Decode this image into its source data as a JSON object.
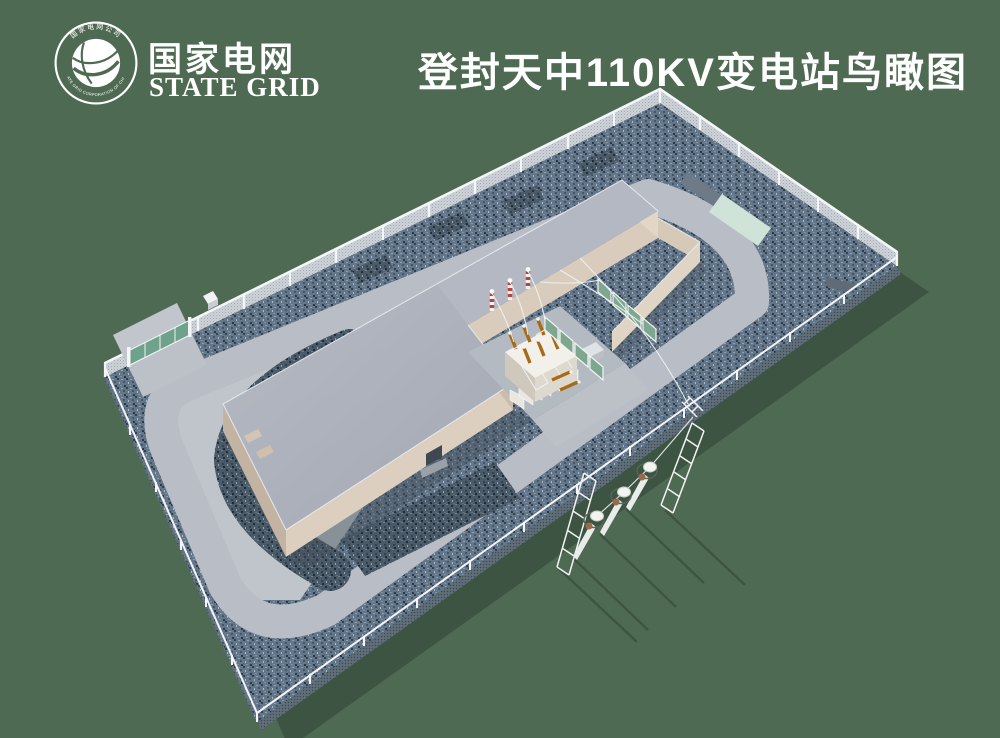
{
  "header": {
    "title": "登封天中110KV变电站鸟瞰图",
    "logo": {
      "zh": "国家电网",
      "en": "STATE GRID",
      "ring_top": "国家电网公司",
      "ring_bottom": "STATE GRID CORPORATION OF CHINA"
    }
  },
  "colors": {
    "background": "#4f6a52",
    "shadow": "#3e5443",
    "gravel": "#66788a",
    "gravel_dark": "#4d5d6b",
    "road": "#b9bec6",
    "concrete": "#c0c5cb",
    "roof": "#abb0bb",
    "roof_wing": "#b3b8c2",
    "wall_tan": "#d9ccbc",
    "fence_white": "#f3f5f7",
    "gate_green": "#6fa28c",
    "screen_green": "#7da78f",
    "pad_mint": "#cfe3d9",
    "transformer_cream": "#f2f0e9",
    "bushing_amber": "#a86a16",
    "insulator_red": "#c24038"
  }
}
